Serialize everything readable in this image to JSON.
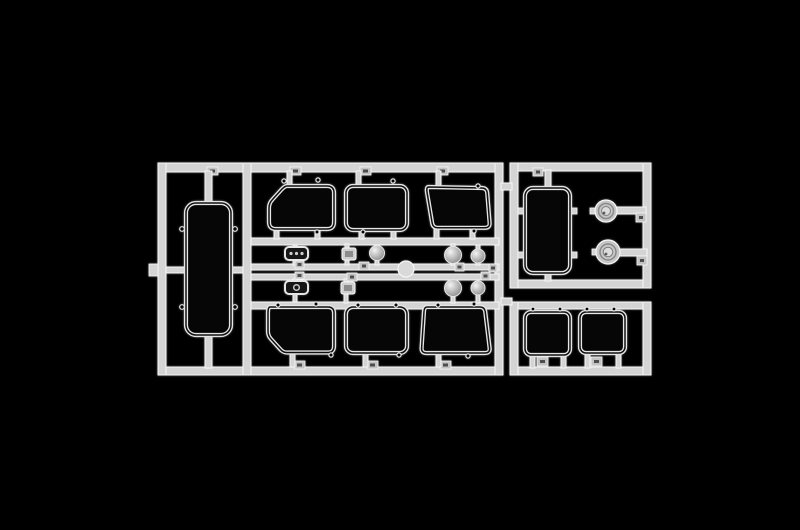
{
  "meta": {
    "description": "Product photograph of a clear plastic model-kit sprue (runner) holding transparent window glazing panels and lamp lenses, lit bright against a pure black background",
    "visible_text": ""
  },
  "palette": {
    "bg": "#000000",
    "runner_fill": "#d4d4d4",
    "runner_edge": "#f7f7f7",
    "glass_fill": "#060606",
    "part_edge": "#e6e6e6",
    "edge_split": "#101010",
    "tag_fill": "#c3c3c3",
    "tag_mark": "#4d4d4d",
    "small_part_fill": "#cfcfcf",
    "lens_hi": "#f4f4f4",
    "lens_lo": "#8c8c8c",
    "disc_fill": "#d9d9d9",
    "lamp_ring": "#8a8a8a"
  },
  "sprue": {
    "material_look": "clear styrene, bright rims with black see-through interiors",
    "left_frame": {
      "parts": [
        {
          "name": "windscreen-glazing",
          "shape": "tall rounded rectangle with side pegs"
        },
        {
          "name": "upper-door-window",
          "shape": "trapezoid, sloped upper-left corner"
        },
        {
          "name": "upper-middle-window",
          "shape": "rounded rectangle"
        },
        {
          "name": "upper-rear-window",
          "shape": "right-leaning parallelogram"
        },
        {
          "name": "lower-door-window",
          "shape": "trapezoid, sloped lower-left corner"
        },
        {
          "name": "lower-middle-window",
          "shape": "rounded rectangle"
        },
        {
          "name": "lower-rear-window",
          "shape": "parallelogram, wider at bottom"
        },
        {
          "name": "marker-light-cluster-three-dot",
          "count": 1
        },
        {
          "name": "marker-light-cluster-ring",
          "count": 1
        },
        {
          "name": "small-lens-block",
          "count": 2
        },
        {
          "name": "round-ball-lens",
          "count": 1
        },
        {
          "name": "flat-round-disc-lens",
          "count": 1
        },
        {
          "name": "dome-lens",
          "count": 4
        }
      ]
    },
    "right_frame_top": {
      "parts": [
        {
          "name": "rear-window-glazing",
          "shape": "tall rounded rectangle with side tabs"
        },
        {
          "name": "stepped-headlamp-lens",
          "count": 2
        }
      ]
    },
    "right_frame_bottom": {
      "parts": [
        {
          "name": "side-window-glazing",
          "shape": "rounded square",
          "count": 2
        }
      ]
    },
    "part_number_tabs": "small molded number tabs along the runners, illegible at this scale"
  }
}
